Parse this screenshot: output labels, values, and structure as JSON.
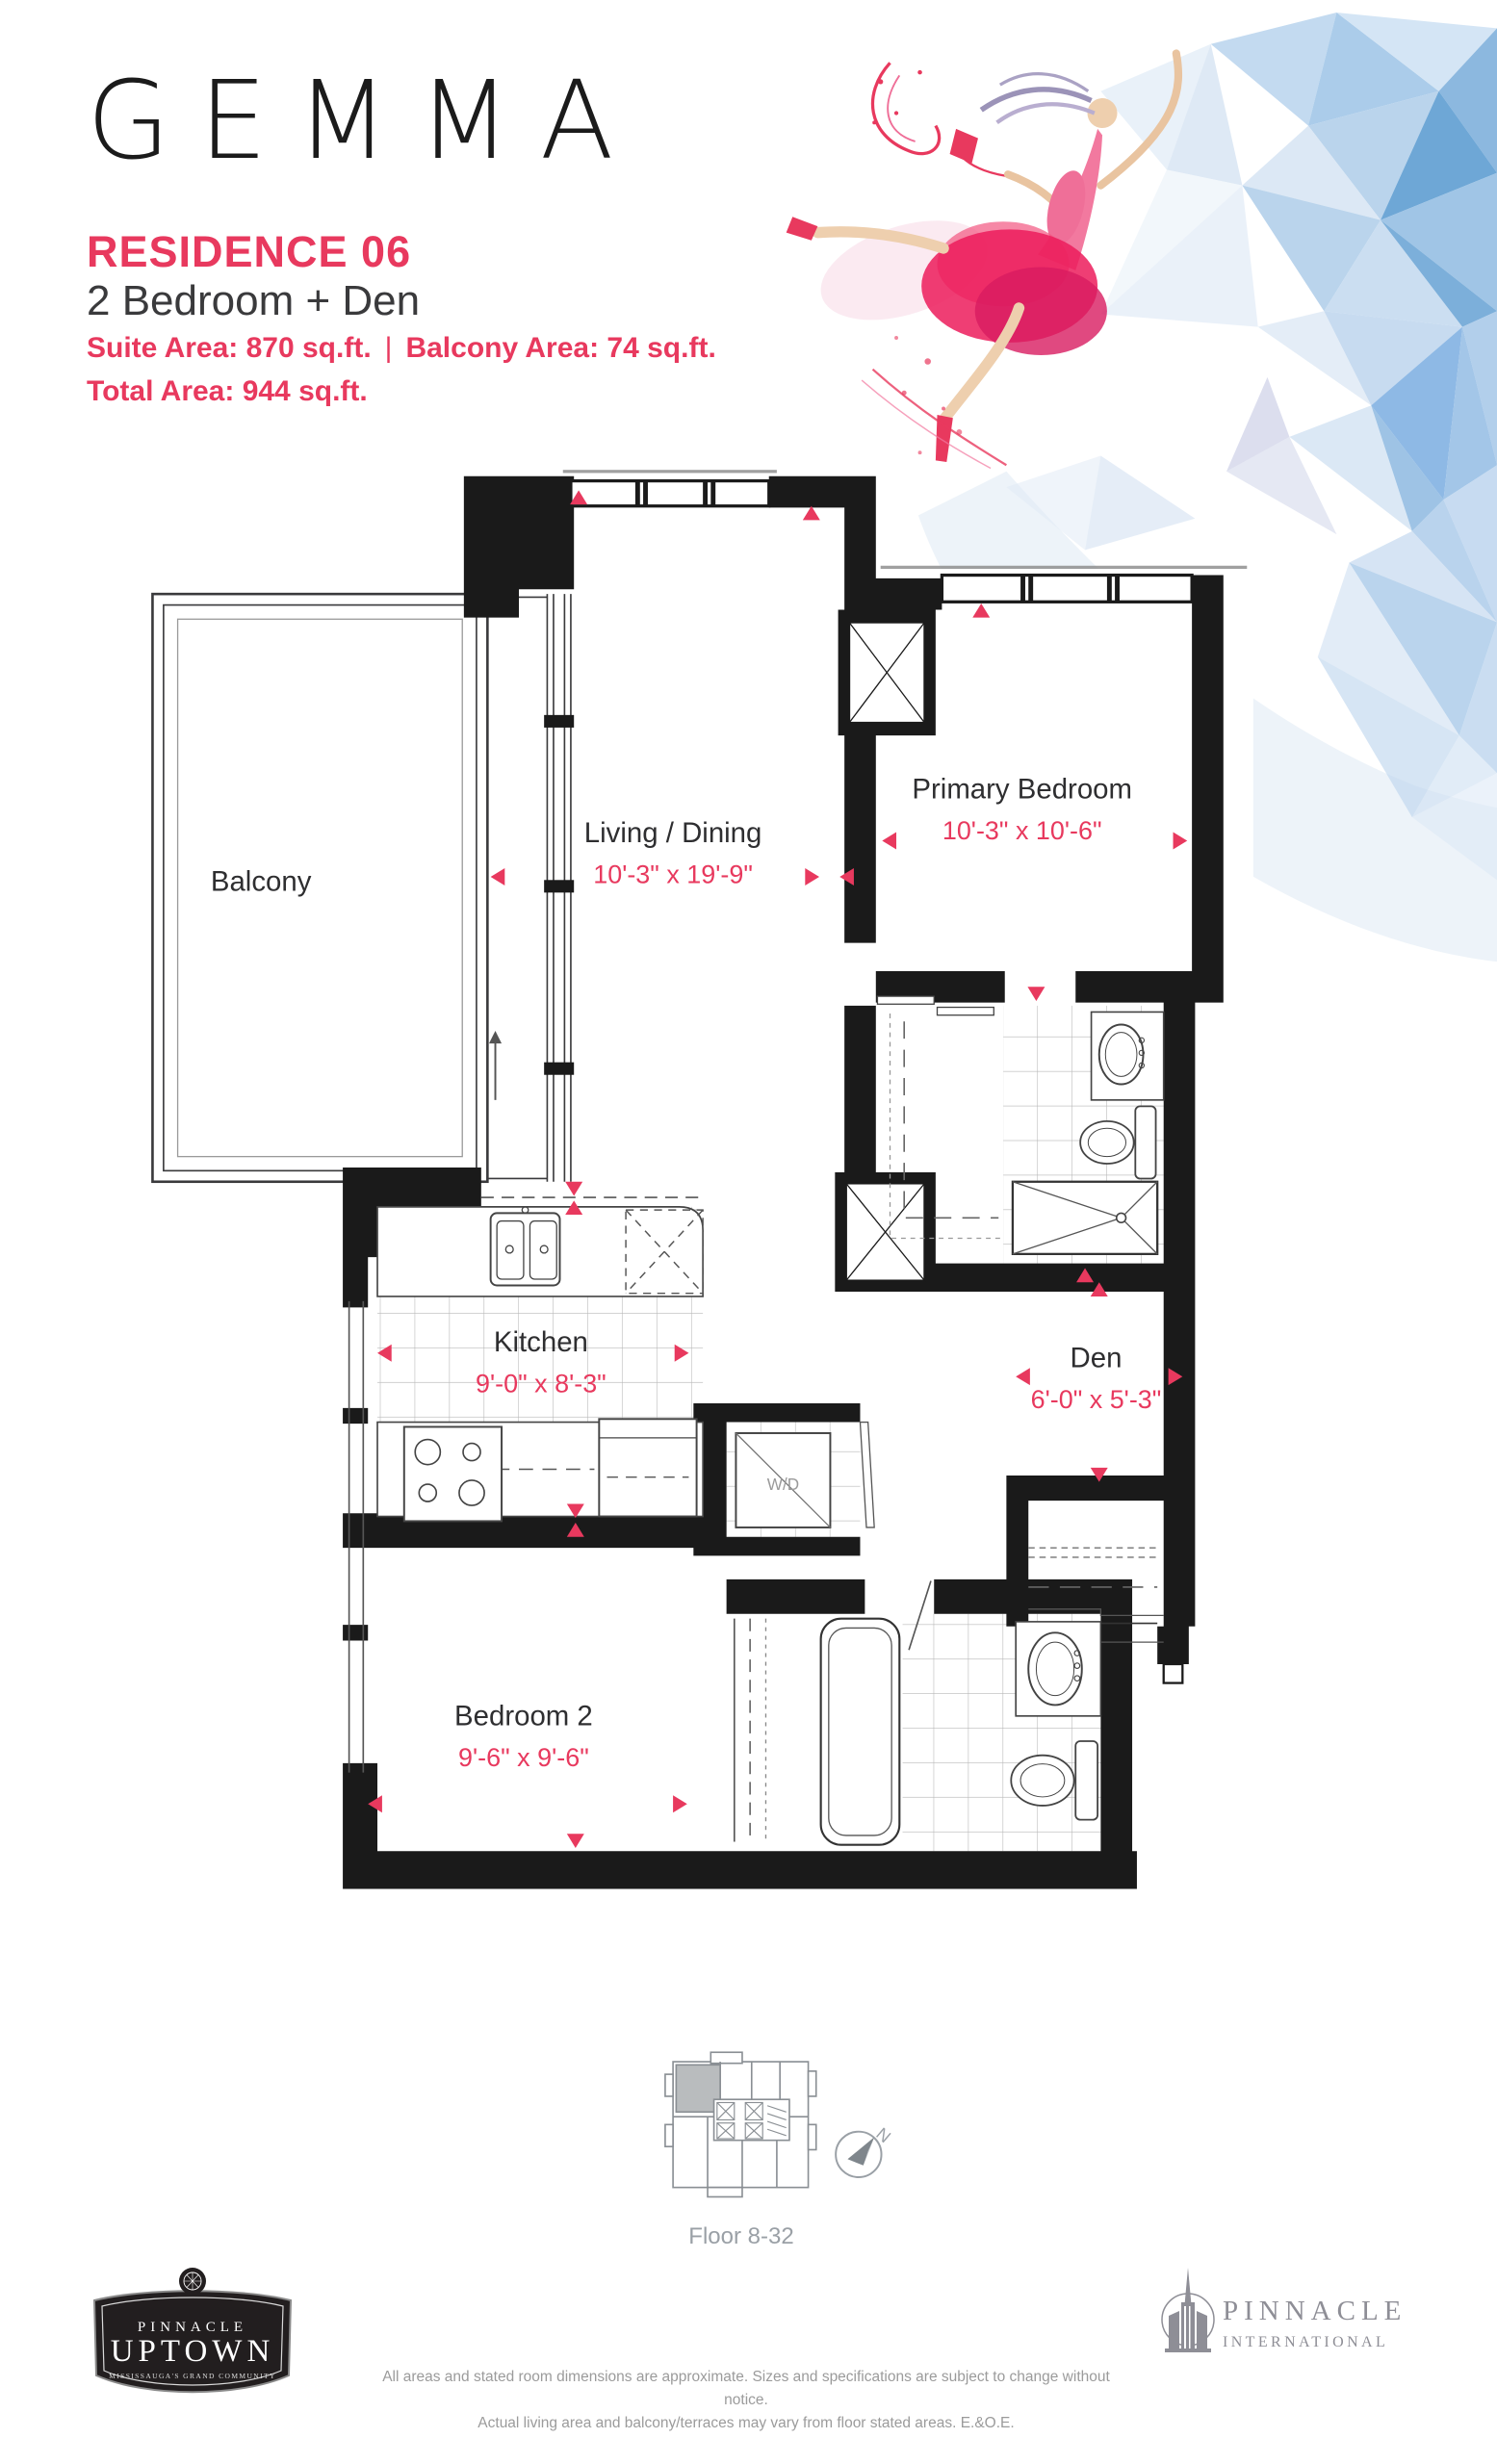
{
  "header": {
    "brand": "GEMMA",
    "residence": "RESIDENCE 06",
    "suite_type": "2 Bedroom + Den",
    "suite_area": "Suite Area: 870 sq.ft.",
    "separator": "|",
    "balcony_area": "Balcony Area: 74 sq.ft.",
    "total_area": "Total Area: 944 sq.ft."
  },
  "plan": {
    "balcony": {
      "label": "Balcony"
    },
    "living": {
      "label": "Living / Dining",
      "dims": "10'-3\" x 19'-9\""
    },
    "primary": {
      "label": "Primary Bedroom",
      "dims": "10'-3\" x 10'-6\""
    },
    "kitchen": {
      "label": "Kitchen",
      "dims": "9'-0\" x 8'-3\""
    },
    "den": {
      "label": "Den",
      "dims": "6'-0\" x 5'-3\""
    },
    "bedroom2": {
      "label": "Bedroom 2",
      "dims": "9'-6\" x 9'-6\""
    },
    "wd": {
      "label": "W/D"
    }
  },
  "keyplan": {
    "floor_range": "Floor 8-32",
    "compass": "N"
  },
  "footer": {
    "disclaimer_line1": "All areas and stated room dimensions are approximate. Sizes and specifications are subject to change without notice.",
    "disclaimer_line2": "Actual living area and balcony/terraces may vary from floor stated areas. E.&O.E.",
    "uptown_logo": {
      "top": "PINNACLE",
      "main": "UPTOWN",
      "tagline": "MISSISSAUGA'S GRAND COMMUNITY"
    },
    "international_logo": {
      "name": "PINNACLE",
      "sub": "INTERNATIONAL"
    }
  },
  "colors": {
    "accent": "#E8395E",
    "ink": "#1A1A1A",
    "text_dark": "#3A3A3C",
    "muted": "#9AA0A6",
    "art_blue": "#7FB0DC"
  }
}
